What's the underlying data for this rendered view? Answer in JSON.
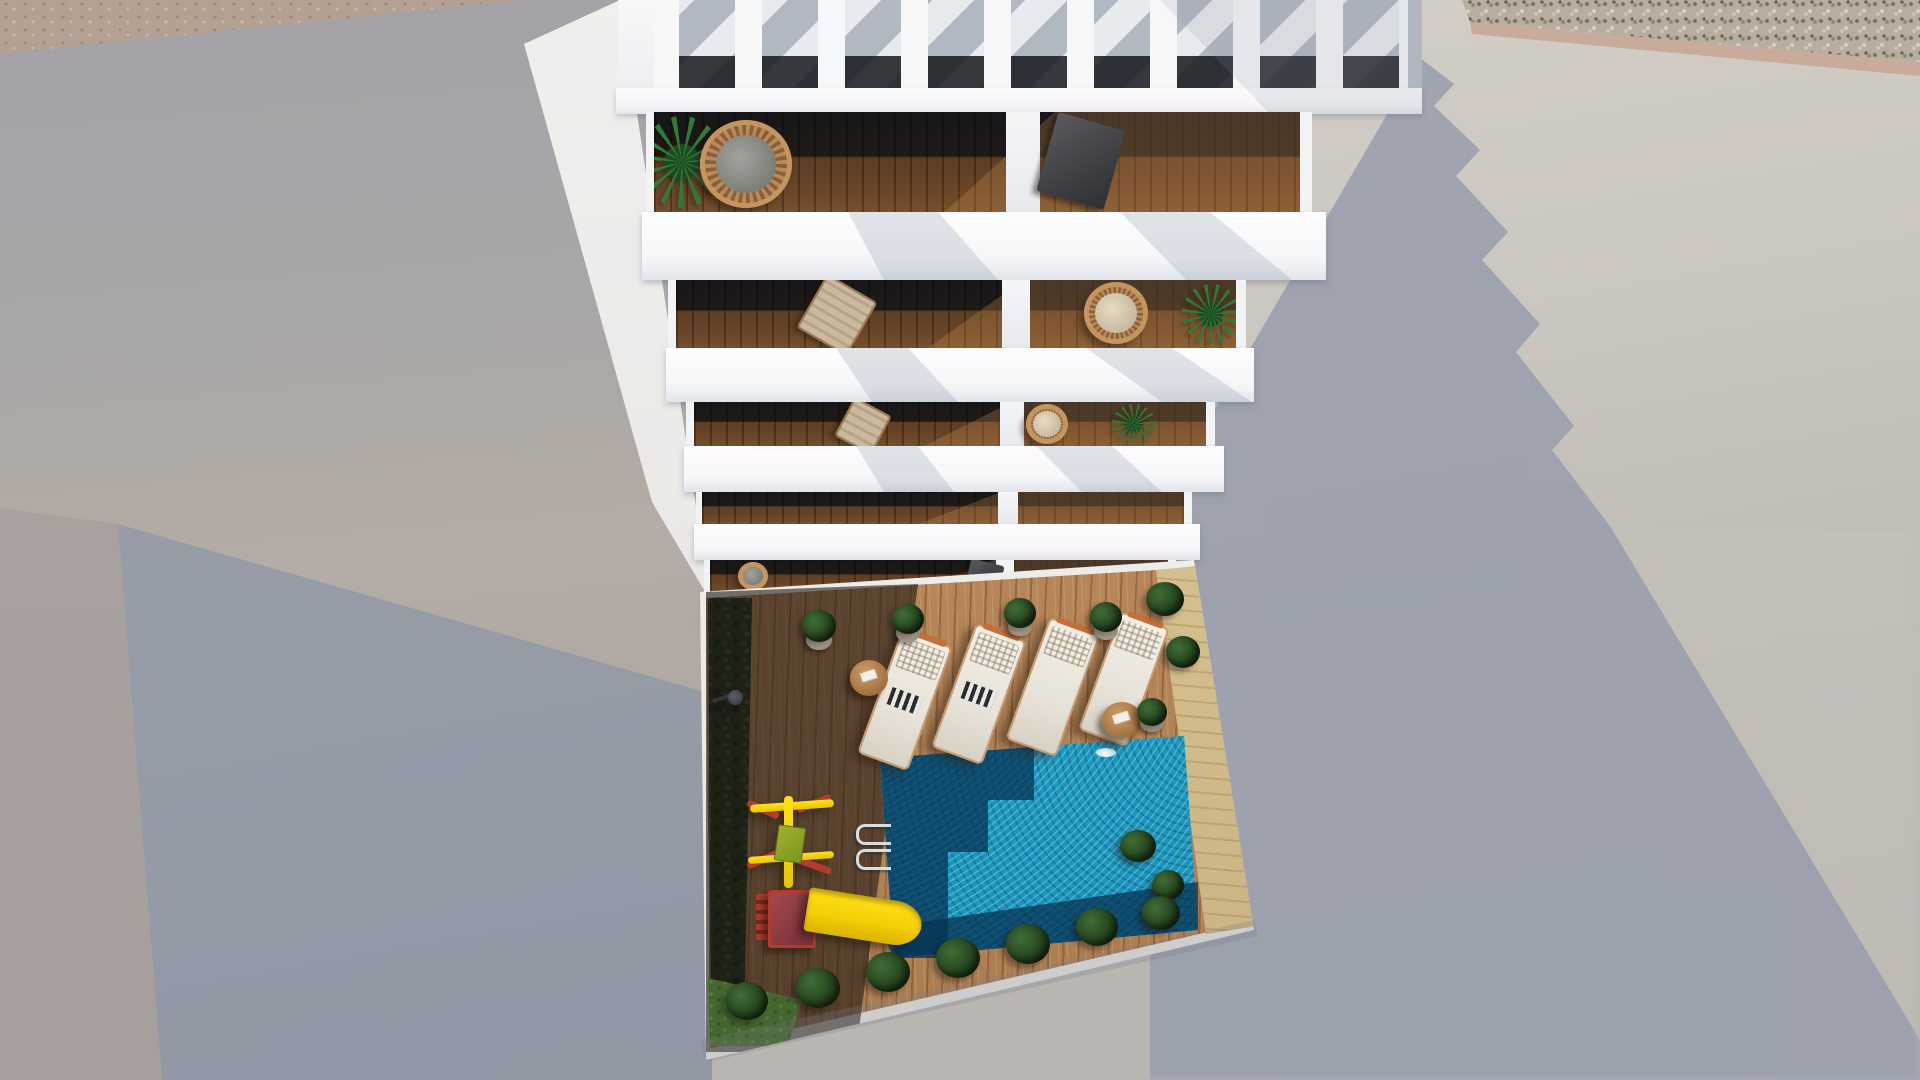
{
  "image": {
    "type": "3d-architectural-render",
    "view": "top-down aerial",
    "subject": "white multi-storey apartment building with slatted pergola roof and stacked balconies above a private courtyard with wooden deck, swimming pool, sun loungers and a children's playground, surrounded by plain neighbouring walls",
    "text_visible": "none"
  },
  "palette": {
    "leftWallTop": "#a3a2a7",
    "leftWallWarm": "#b1aaa3",
    "leftFaceA": "#a79f9c",
    "leftFaceB": "#9aa0ab",
    "tanStrip": "#b3a294",
    "gravelBase": "#b7ae9f",
    "tanBand": "#c9ab9b",
    "rightWallLight": "#d3cec6",
    "shadowBlue": "#999fae",
    "interiorGlass": "#17161a",
    "interiorWood": "#5d3d24",
    "woodDeck": "#b8885a",
    "hedge": "#1d2e18",
    "sand": "#d6c08d",
    "poolBright": "#1ea4c9",
    "poolDark": "rgba(7,50,82,0.74)",
    "plantGreen": "#2f7a38",
    "plantDark": "#16280f",
    "cushion": "#e7dbc4",
    "loungerBody": "#e8e3d8",
    "loungerFrame": "#c79d74",
    "slideYellow": "#e8c400",
    "slideRed": "#c4703a",
    "playRed": "#b23b2e",
    "tableWood": "#9c6a3a"
  },
  "building": {
    "pergola": {
      "slats": 9,
      "shadow_stripes": "diagonal"
    },
    "balcony_rows": 5,
    "balconies_per_row": 2,
    "furniture_rows": [
      {
        "row": 1,
        "left": [
          "palm plant",
          "round wicker chair",
          "leafy plant"
        ],
        "right": [
          "dark lounge chair",
          "leafy plant"
        ]
      },
      {
        "row": 2,
        "left": [
          "leafy plant",
          "beige deck chair"
        ],
        "right": [
          "wicker peacock chair",
          "palm plant"
        ]
      },
      {
        "row": 3,
        "left": [
          "leafy plant",
          "beige deck chair"
        ],
        "right": [
          "wicker chair",
          "palm plant"
        ]
      },
      {
        "row": 4,
        "left": [],
        "right": []
      },
      {
        "row": 5,
        "left": [
          "wicker chair",
          "potted plants"
        ],
        "right": [
          "dark chair",
          "potted plant"
        ]
      }
    ]
  },
  "courtyard": {
    "pool": {
      "count": 1,
      "ladder": true,
      "shaded_area": "stepped shadow on left and bottom"
    },
    "sun_loungers": 4,
    "side_tables": 2,
    "playground": [
      "swing set",
      "yellow slide with red platform"
    ],
    "outdoor_shower": true,
    "potted_plants_along_building": 4,
    "hedge_left": true,
    "bush_row_bottom": true,
    "sand_strip_right": true
  },
  "environment": {
    "top_right": "gravel roof strip",
    "right_wall": "sunlit with large blue-grey building shadow",
    "left_wall": "shaded grey with inner corner at lower left"
  }
}
